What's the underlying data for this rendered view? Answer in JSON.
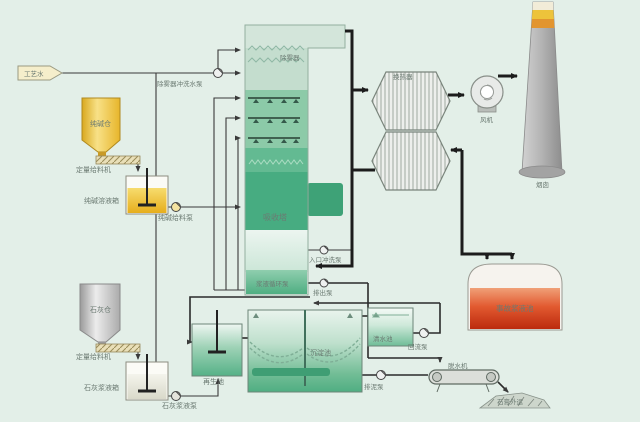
{
  "diagram": {
    "water": {
      "source": "工艺水",
      "wash_pump": "除雾器冲洗水泵"
    },
    "soda": {
      "silo": "纯碱仓",
      "feeder": "定量给料机",
      "tank": "纯碱溶液箱",
      "pump": "纯碱给料泵"
    },
    "lime": {
      "silo": "石灰仓",
      "feeder": "定量给料机",
      "tank": "石灰浆液箱",
      "pump": "石灰浆液泵"
    },
    "absorber": {
      "name": "吸收塔",
      "demister": "除雾器",
      "circulation_pump": "浆液循环泵",
      "inlet_flush_pump": "入口冲洗泵",
      "discharge_pump": "排出泵"
    },
    "gas": {
      "heat_exchanger": "换热器",
      "fan": "风机",
      "chimney": "烟囱"
    },
    "emergency_tank": "事故浆液池",
    "treatment": {
      "regeneration_tank": "再生池",
      "settling_tank": "沉淀池",
      "clear_water_tank": "清水池",
      "return_pump": "回流泵",
      "sludge_pump": "排泥泵",
      "dewaterer": "脱水机",
      "gypsum": "石膏外运"
    }
  },
  "colors": {
    "background": "#e3efe8",
    "tower_green": "#47ac81",
    "pipe_black": "#1c1c1c",
    "emergency_red": "#d23a16",
    "silo_yellow": "#f2cf56",
    "chimney_gray": "#a8a8a8"
  }
}
